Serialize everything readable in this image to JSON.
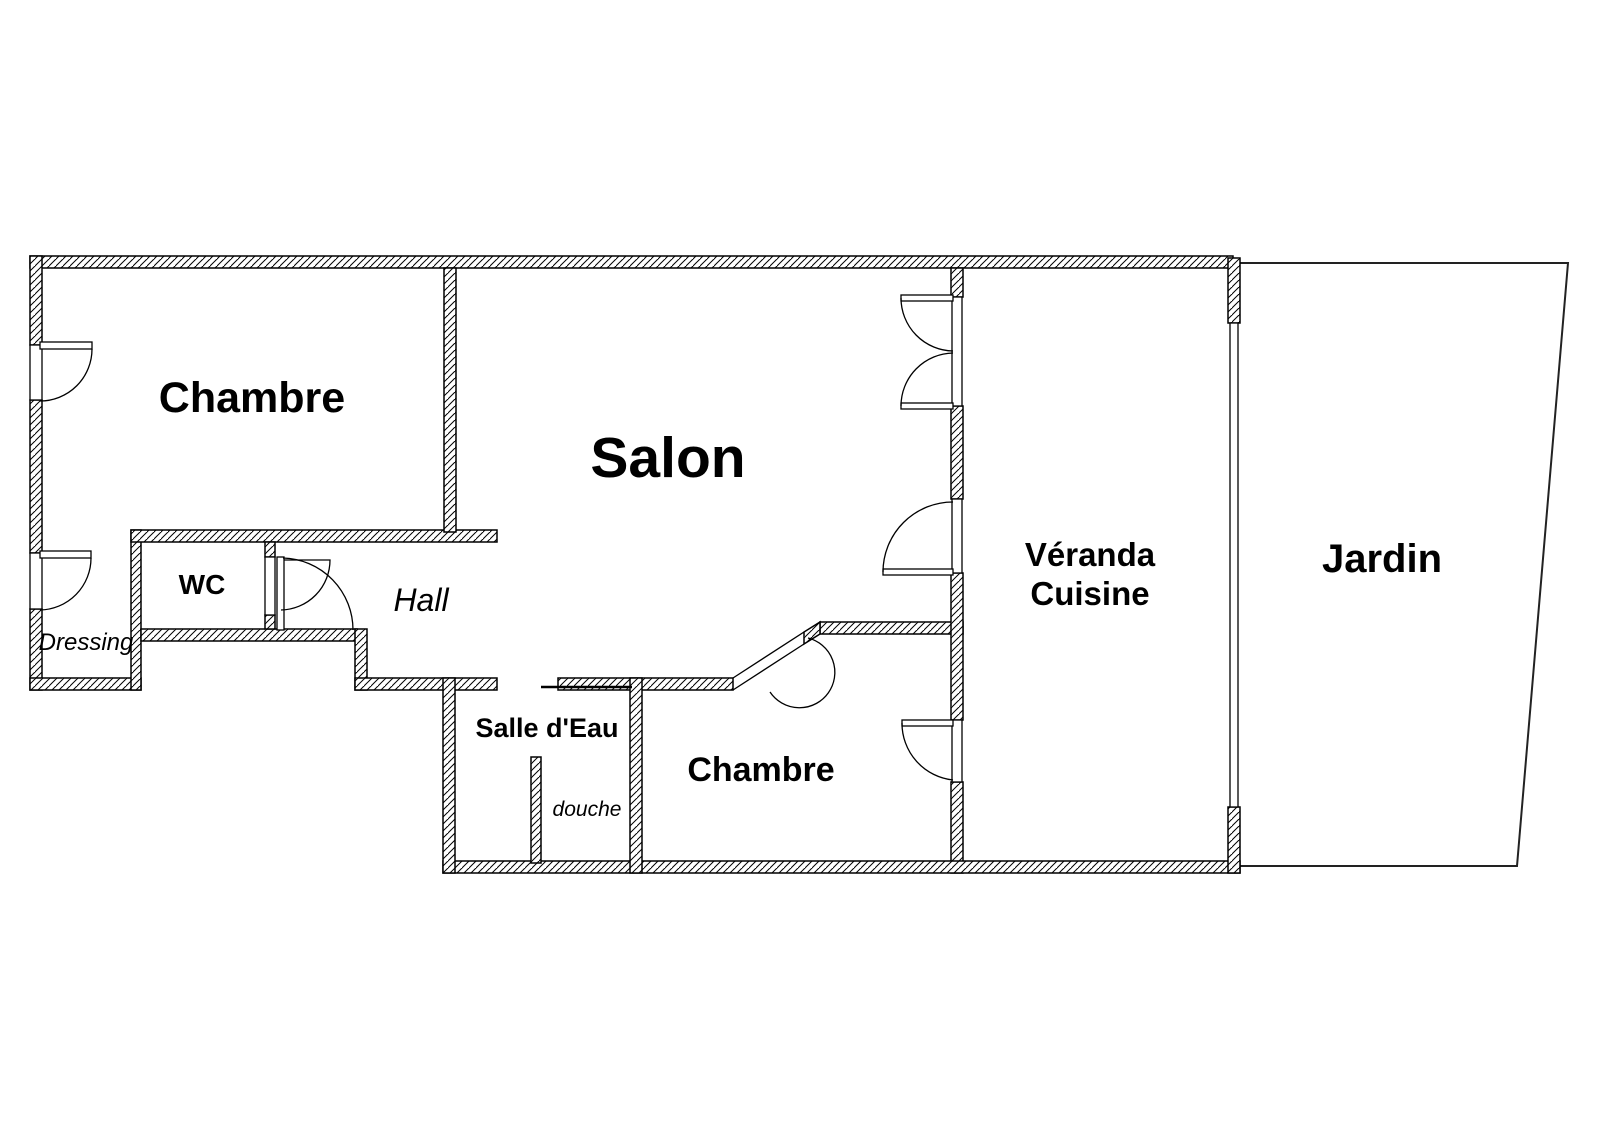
{
  "plan": {
    "type": "floor-plan",
    "rooms": {
      "chambre_top": {
        "label": "Chambre"
      },
      "salon": {
        "label": "Salon"
      },
      "wc": {
        "label": "WC"
      },
      "hall": {
        "label": "Hall"
      },
      "dressing": {
        "label": "Dressing"
      },
      "salle_deau": {
        "label": "Salle d'Eau"
      },
      "douche": {
        "label": "douche"
      },
      "chambre_bottom": {
        "label": "Chambre"
      },
      "veranda_cuisine": {
        "line1": "Véranda",
        "line2": "Cuisine"
      },
      "jardin": {
        "label": "Jardin"
      }
    },
    "colors": {
      "ink": "#000000",
      "paper": "#ffffff",
      "thin_line": "#222222"
    }
  }
}
